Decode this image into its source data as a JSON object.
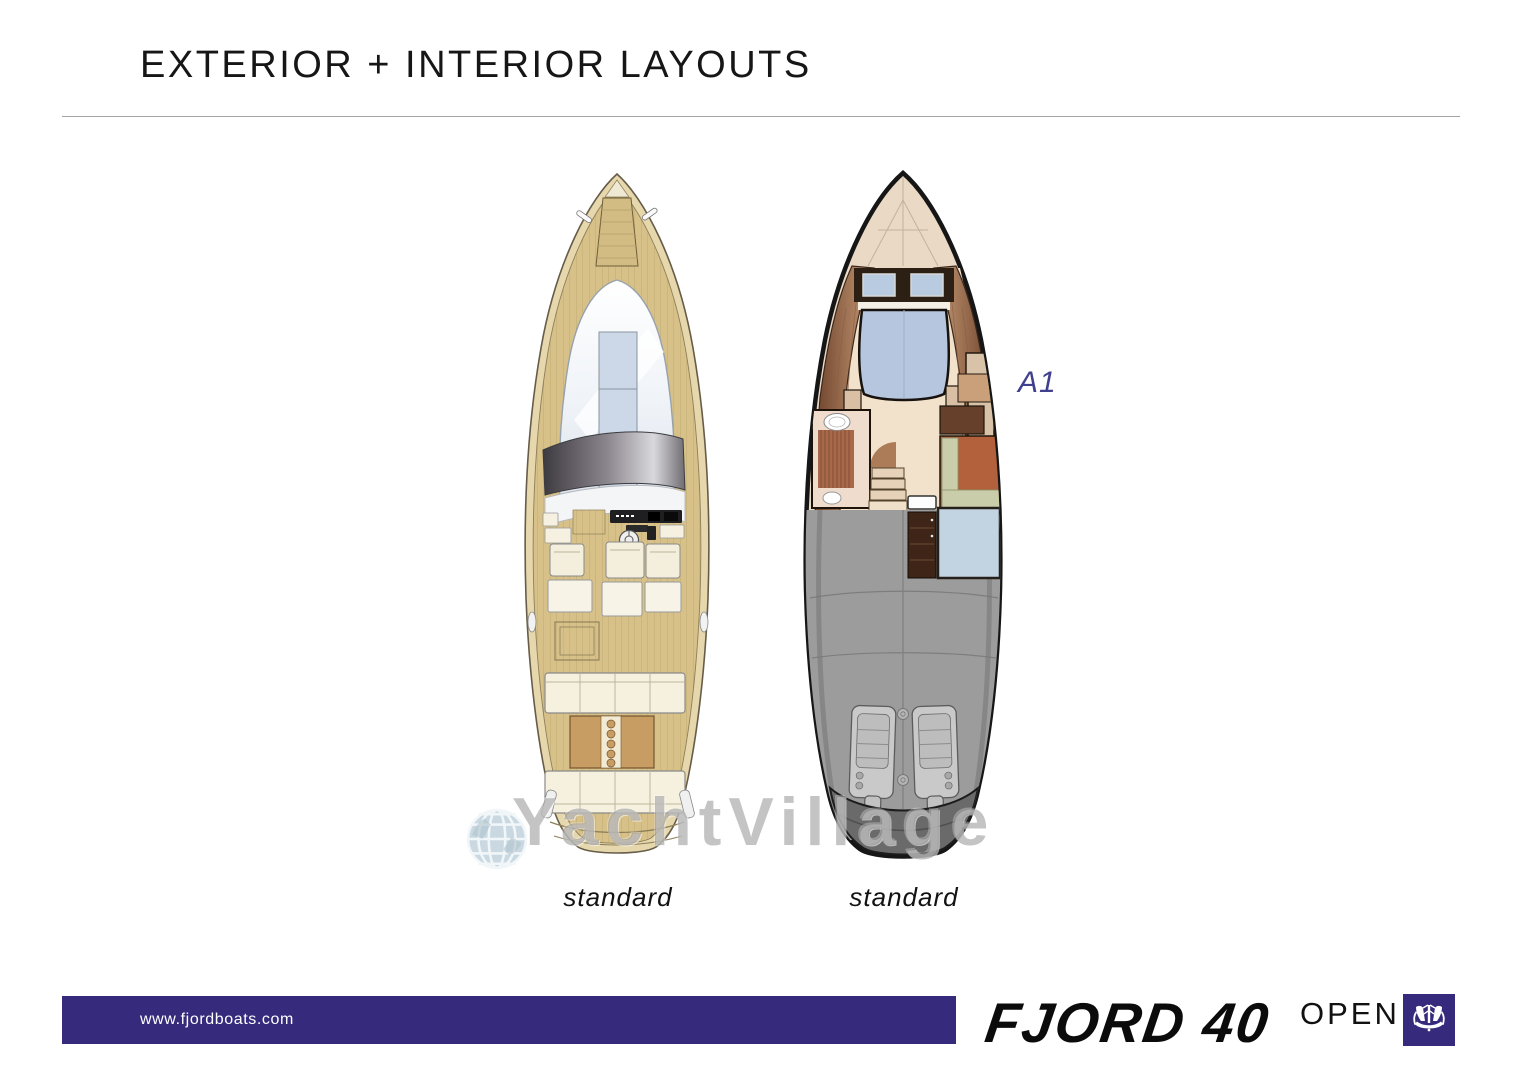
{
  "page": {
    "title": "EXTERIOR + INTERIOR LAYOUTS"
  },
  "figures": [
    {
      "name": "exterior-deck-plan",
      "caption": "standard"
    },
    {
      "name": "interior-layout-plan",
      "caption": "standard",
      "variant_label": "A1"
    }
  ],
  "watermark": {
    "text": "YachtVillage",
    "icon": "globe-icon"
  },
  "footer": {
    "website": "www.fjordboats.com",
    "brand_name": "FJORD 40",
    "brand_suffix": "OPEN",
    "bar_color": "#362a7c"
  },
  "colors": {
    "accent_indigo": "#362a7c",
    "teak_deck": "#d7c189",
    "interior_floor": "#f2e1cb",
    "bed_upholstery": "#b6c6df",
    "engine_bay_gray": "#9c9c9c",
    "variant_label_color": "#40408e"
  }
}
